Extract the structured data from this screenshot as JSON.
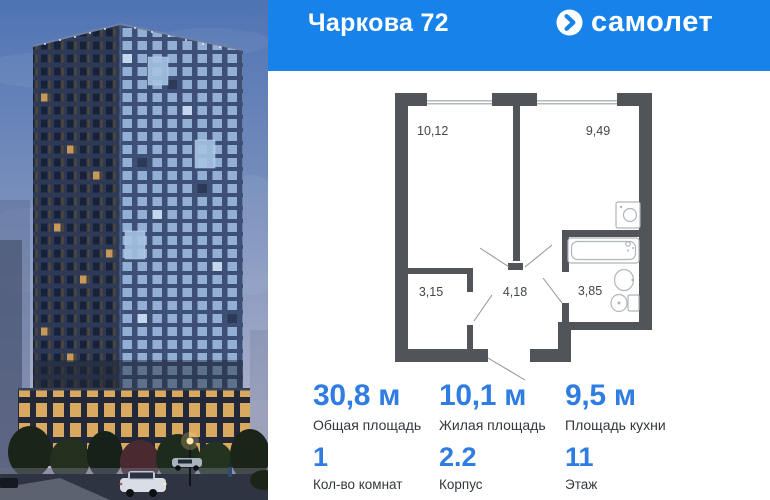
{
  "header": {
    "title": "Чаркова 72",
    "brand": "самолет"
  },
  "floorplan": {
    "rooms": [
      {
        "id": "room-main",
        "area": "10,12"
      },
      {
        "id": "room-kitchen",
        "area": "9,49"
      },
      {
        "id": "room-wardrobe",
        "area": "3,15"
      },
      {
        "id": "room-hall",
        "area": "4,18"
      },
      {
        "id": "room-bathroom",
        "area": "3,85"
      }
    ]
  },
  "stats": {
    "areas": [
      {
        "value": "30,8 м",
        "label": "Общая площадь"
      },
      {
        "value": "10,1 м",
        "label": "Жилая площадь"
      },
      {
        "value": "9,5 м",
        "label": "Площадь кухни"
      }
    ],
    "details": [
      {
        "value": "1",
        "label": "Кол-во комнат"
      },
      {
        "value": "2.2",
        "label": "Корпус"
      },
      {
        "value": "11",
        "label": "Этаж"
      }
    ]
  },
  "icons": {
    "brand_mark": "arrow-in-circle",
    "fixtures": [
      "washing-machine",
      "bathtub",
      "sink",
      "toilet"
    ]
  },
  "colors": {
    "brand_blue": "#1682ea",
    "stat_blue": "#2f7de2",
    "wall_gray": "#515459"
  }
}
